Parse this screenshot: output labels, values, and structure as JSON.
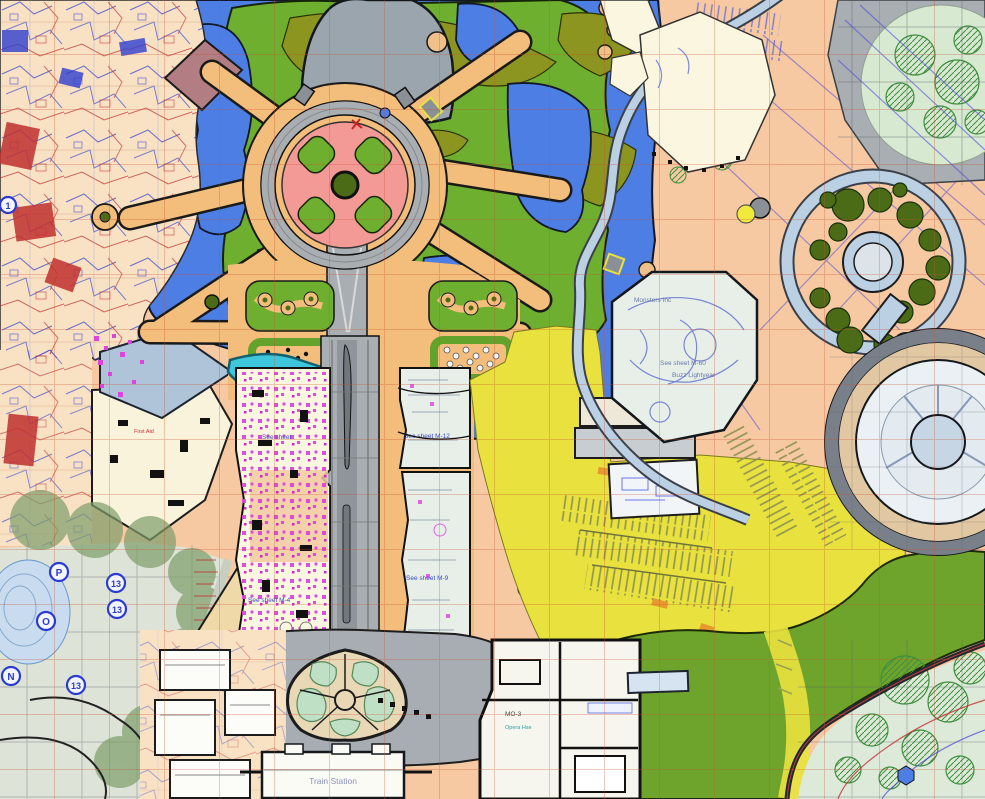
{
  "map": {
    "labels": {
      "sheet_left": "See sheet",
      "sheet_m12": "See sheet M-12",
      "sheet_m9": "See sheet M-9",
      "sheet_m4": "See sheet M-4",
      "monsters": "Monsters Inc",
      "sheet_m60": "See sheet M-60",
      "buzz": "Buzz Lightyear",
      "first_aid": "First Aid",
      "train_station": "Train Station",
      "mo3": "MO-3",
      "opera": "Opera Hse"
    },
    "markers": {
      "p": "P",
      "o": "O",
      "n": "N",
      "n13a": "13",
      "n13b": "13",
      "n13c": "13",
      "n1": "1"
    },
    "palette": {
      "lake_blue": "#4D7EE4",
      "lawn_green": "#6FAF2F",
      "olive_green": "#8C951F",
      "path_tan": "#F3BE7C",
      "hub_pink": "#F49A96",
      "road_gray": "#A9AEB3",
      "plaza_gray": "#A7ADB2",
      "building_cream": "#FBF6DF",
      "furniture_magenta": "#DD44DD",
      "parking_yellow": "#E9E23E",
      "ground_salmon": "#F6C9A2",
      "cad_peach": "#F9E2C4",
      "monorail_blue": "#BCD0E4",
      "tree_dark_green": "#4C6B16",
      "pale_mint": "#E7EFE8",
      "pale_green": "#DEEAD9",
      "berm_green": "#6FA42C",
      "river_teal": "#3EC6DC",
      "roof_bluegray": "#AFC4D8",
      "grid_red": "#C8502F",
      "cad_blue": "#2F3FD0",
      "cad_red": "#C03030"
    }
  }
}
